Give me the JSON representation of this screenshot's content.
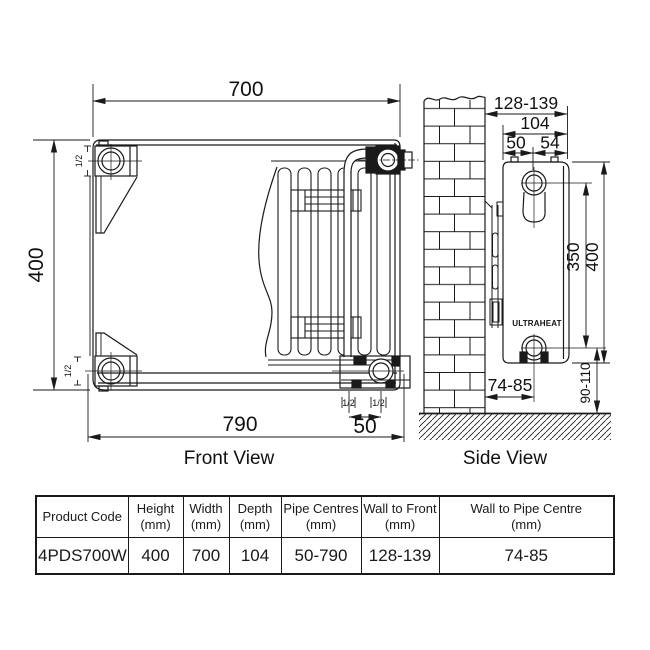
{
  "front_view": {
    "title": "Front View",
    "dim_top_width": "700",
    "dim_left_height": "400",
    "dim_bottom_width": "790",
    "dim_pipe_spacing": "50",
    "conn_size_top_left": "1/2",
    "conn_size_bottom_left": "1/2",
    "conn_size_bottom_a": "1/2",
    "conn_size_bottom_b": "1/2"
  },
  "side_view": {
    "title": "Side View",
    "brand": "ULTRAHEAT",
    "dim_wall_to_front": "128-139",
    "dim_depth": "104",
    "dim_back_to_pipe": "50",
    "dim_pipe_to_front": "54",
    "dim_pipe_centres_height": "350",
    "dim_height": "400",
    "dim_wall_to_pipe_centre": "74-85",
    "dim_floor_to_pipe": "90-110"
  },
  "table": {
    "headers": [
      {
        "label": "Product Code",
        "unit": ""
      },
      {
        "label": "Height",
        "unit": "(mm)"
      },
      {
        "label": "Width",
        "unit": "(mm)"
      },
      {
        "label": "Depth",
        "unit": "(mm)"
      },
      {
        "label": "Pipe Centres",
        "unit": "(mm)"
      },
      {
        "label": "Wall to Front",
        "unit": "(mm)"
      },
      {
        "label": "Wall to Pipe Centre",
        "unit": "(mm)"
      }
    ],
    "row": [
      "4PDS700W",
      "400",
      "700",
      "104",
      "50-790",
      "128-139",
      "74-85"
    ]
  },
  "colors": {
    "line": "#1a1a1a",
    "brand_text": "#222a50",
    "background": "#ffffff"
  }
}
